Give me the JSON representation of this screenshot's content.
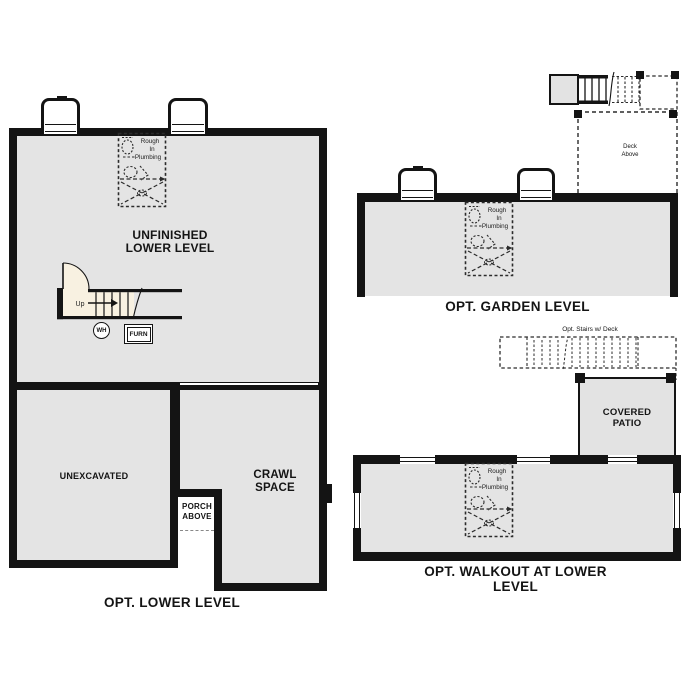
{
  "colors": {
    "wall": "#141414",
    "floor": "#e4e4e4",
    "door_swing": "#f8f1e1",
    "background": "#ffffff"
  },
  "plans": {
    "lower": {
      "caption": "OPT. LOWER LEVEL",
      "main_room": {
        "line1": "UNFINISHED",
        "line2": "LOWER LEVEL"
      },
      "unexcavated": "UNEXCAVATED",
      "crawl": {
        "line1": "CRAWL",
        "line2": "SPACE"
      },
      "porch": {
        "line1": "PORCH",
        "line2": "ABOVE"
      },
      "up": "Up",
      "wh": "WH",
      "furn": "FURN"
    },
    "garden": {
      "caption": "OPT. GARDEN LEVEL",
      "deck": {
        "line1": "Deck",
        "line2": "Above"
      }
    },
    "walkout": {
      "caption": "OPT. WALKOUT AT LOWER LEVEL",
      "patio": {
        "line1": "COVERED",
        "line2": "PATIO"
      },
      "stairs_label": "Opt. Stairs w/ Deck"
    },
    "plumbing": {
      "line1": "Rough",
      "line2": "In",
      "line3": "Plumbing"
    }
  }
}
